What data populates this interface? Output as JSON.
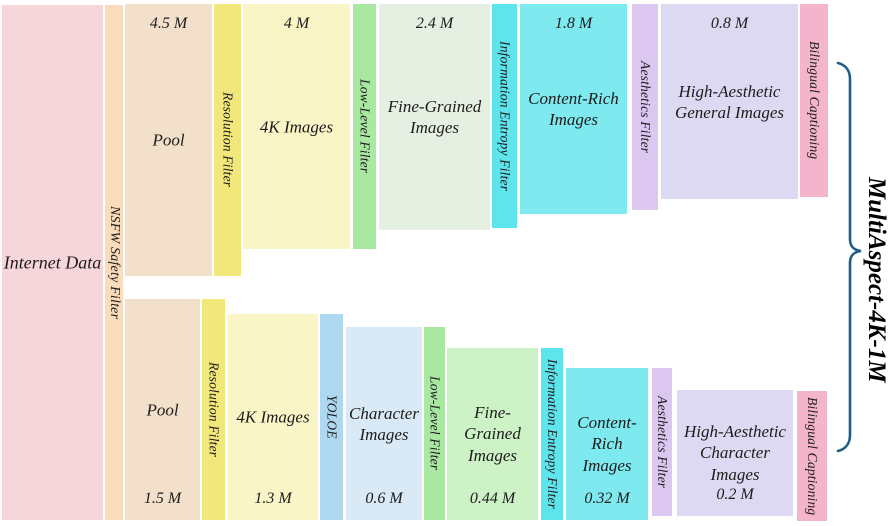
{
  "title": {
    "label": "MultiAspect-4K-1M"
  },
  "source": {
    "label": "Internet Data"
  },
  "safety_filter": {
    "label": "NSFW Safety Filter"
  },
  "top_branch": {
    "pool": {
      "label": "Pool",
      "count": "4.5 M"
    },
    "resolution_filter": {
      "label": "Resolution Filter"
    },
    "images_4k": {
      "label": "4K Images",
      "count": "4 M"
    },
    "low_level_filter": {
      "label": "Low-Level Filter"
    },
    "fine_grained_images": {
      "label": "Fine-Grained\nImages",
      "count": "2.4 M"
    },
    "information_entropy_filter": {
      "label": "Information Entropy Filter"
    },
    "content_rich_images": {
      "label": "Content-Rich\nImages",
      "count": "1.8 M"
    },
    "aesthetics_filter": {
      "label": "Aesthetics Filter"
    },
    "high_aesthetic_images": {
      "label": "High-Aesthetic\nGeneral Images",
      "count": "0.8 M"
    },
    "bilingual_captioning": {
      "label": "Bilingual Captioning"
    }
  },
  "bottom_branch": {
    "pool": {
      "label": "Pool",
      "count": "1.5 M"
    },
    "resolution_filter": {
      "label": "Resolution Filter"
    },
    "images_4k": {
      "label": "4K Images",
      "count": "1.3 M"
    },
    "yoloe_filter": {
      "label": "YOLOE"
    },
    "character_images": {
      "label": "Character\nImages",
      "count": "0.6 M"
    },
    "low_level_filter": {
      "label": "Low-Level Filter"
    },
    "fine_grained_images": {
      "label": "Fine-Grained\nImages",
      "count": "0.44 M"
    },
    "information_entropy_filter": {
      "label": "Information Entropy Filter"
    },
    "content_rich_images": {
      "label": "Content-\nRich Images",
      "count": "0.32 M"
    },
    "aesthetics_filter": {
      "label": "Aesthetics Filter"
    },
    "high_aesthetic_images": {
      "label": "High-Aesthetic\nCharacter Images",
      "count": "0.2 M"
    },
    "bilingual_captioning": {
      "label": "Bilingual Captioning"
    }
  },
  "colors": {
    "internet_data": "#f6d6db",
    "nsfw_filter": "#f8dcbc",
    "pool": "#f2e0ca",
    "resolution_filter": "#f1e77a",
    "images_4k": "#faf5c6",
    "yoloe_filter": "#aed8f0",
    "character_images": "#d9eaf6",
    "low_level_filter": "#a9e8a1",
    "fine_grained_top": "#e5f0e2",
    "fine_grained_bottom": "#cdf2c5",
    "information_entropy_filter": "#5ee5ec",
    "content_rich_images": "#7eeaf0",
    "aesthetics_filter": "#dcc7f0",
    "high_aesthetic_images": "#ded9f3",
    "bilingual_captioning": "#f4b4cb",
    "brace": "#1f5e86",
    "text": "#1c1c1c"
  }
}
